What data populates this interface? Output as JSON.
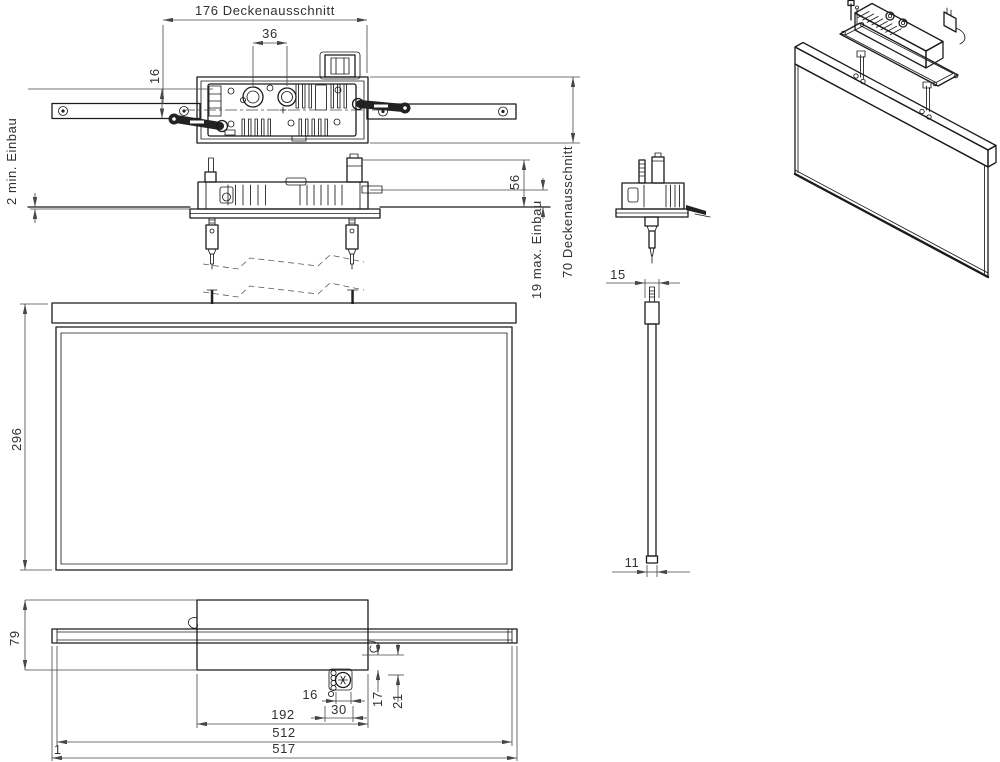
{
  "palette": {
    "background": "#ffffff",
    "line": "#1b1b1b",
    "dim_line": "#474747",
    "text": "#303030"
  },
  "views": {
    "top": {
      "dims": {
        "cutout_width": "176 Deckenausschnitt",
        "gland_spacing": "36",
        "rail_offset": "16",
        "cutout_depth": "70 Deckenausschnitt"
      }
    },
    "side": {
      "dims": {
        "min_recess": "2 min. Einbau",
        "above_ceiling": "56",
        "max_recess": "19 max. Einbau"
      }
    },
    "panel_edge": {
      "dims": {
        "profile_width": "15",
        "panel_thickness": "11"
      }
    },
    "front": {
      "dims": {
        "panel_height": "296"
      }
    },
    "bottom": {
      "dims": {
        "overall_depth": "79",
        "detail_width": "16",
        "detail_pitch": "30",
        "offset_a": "17",
        "offset_b": "21",
        "tray_length": "192",
        "panel_length": "512",
        "overall_length": "517"
      },
      "mark": "1"
    }
  }
}
